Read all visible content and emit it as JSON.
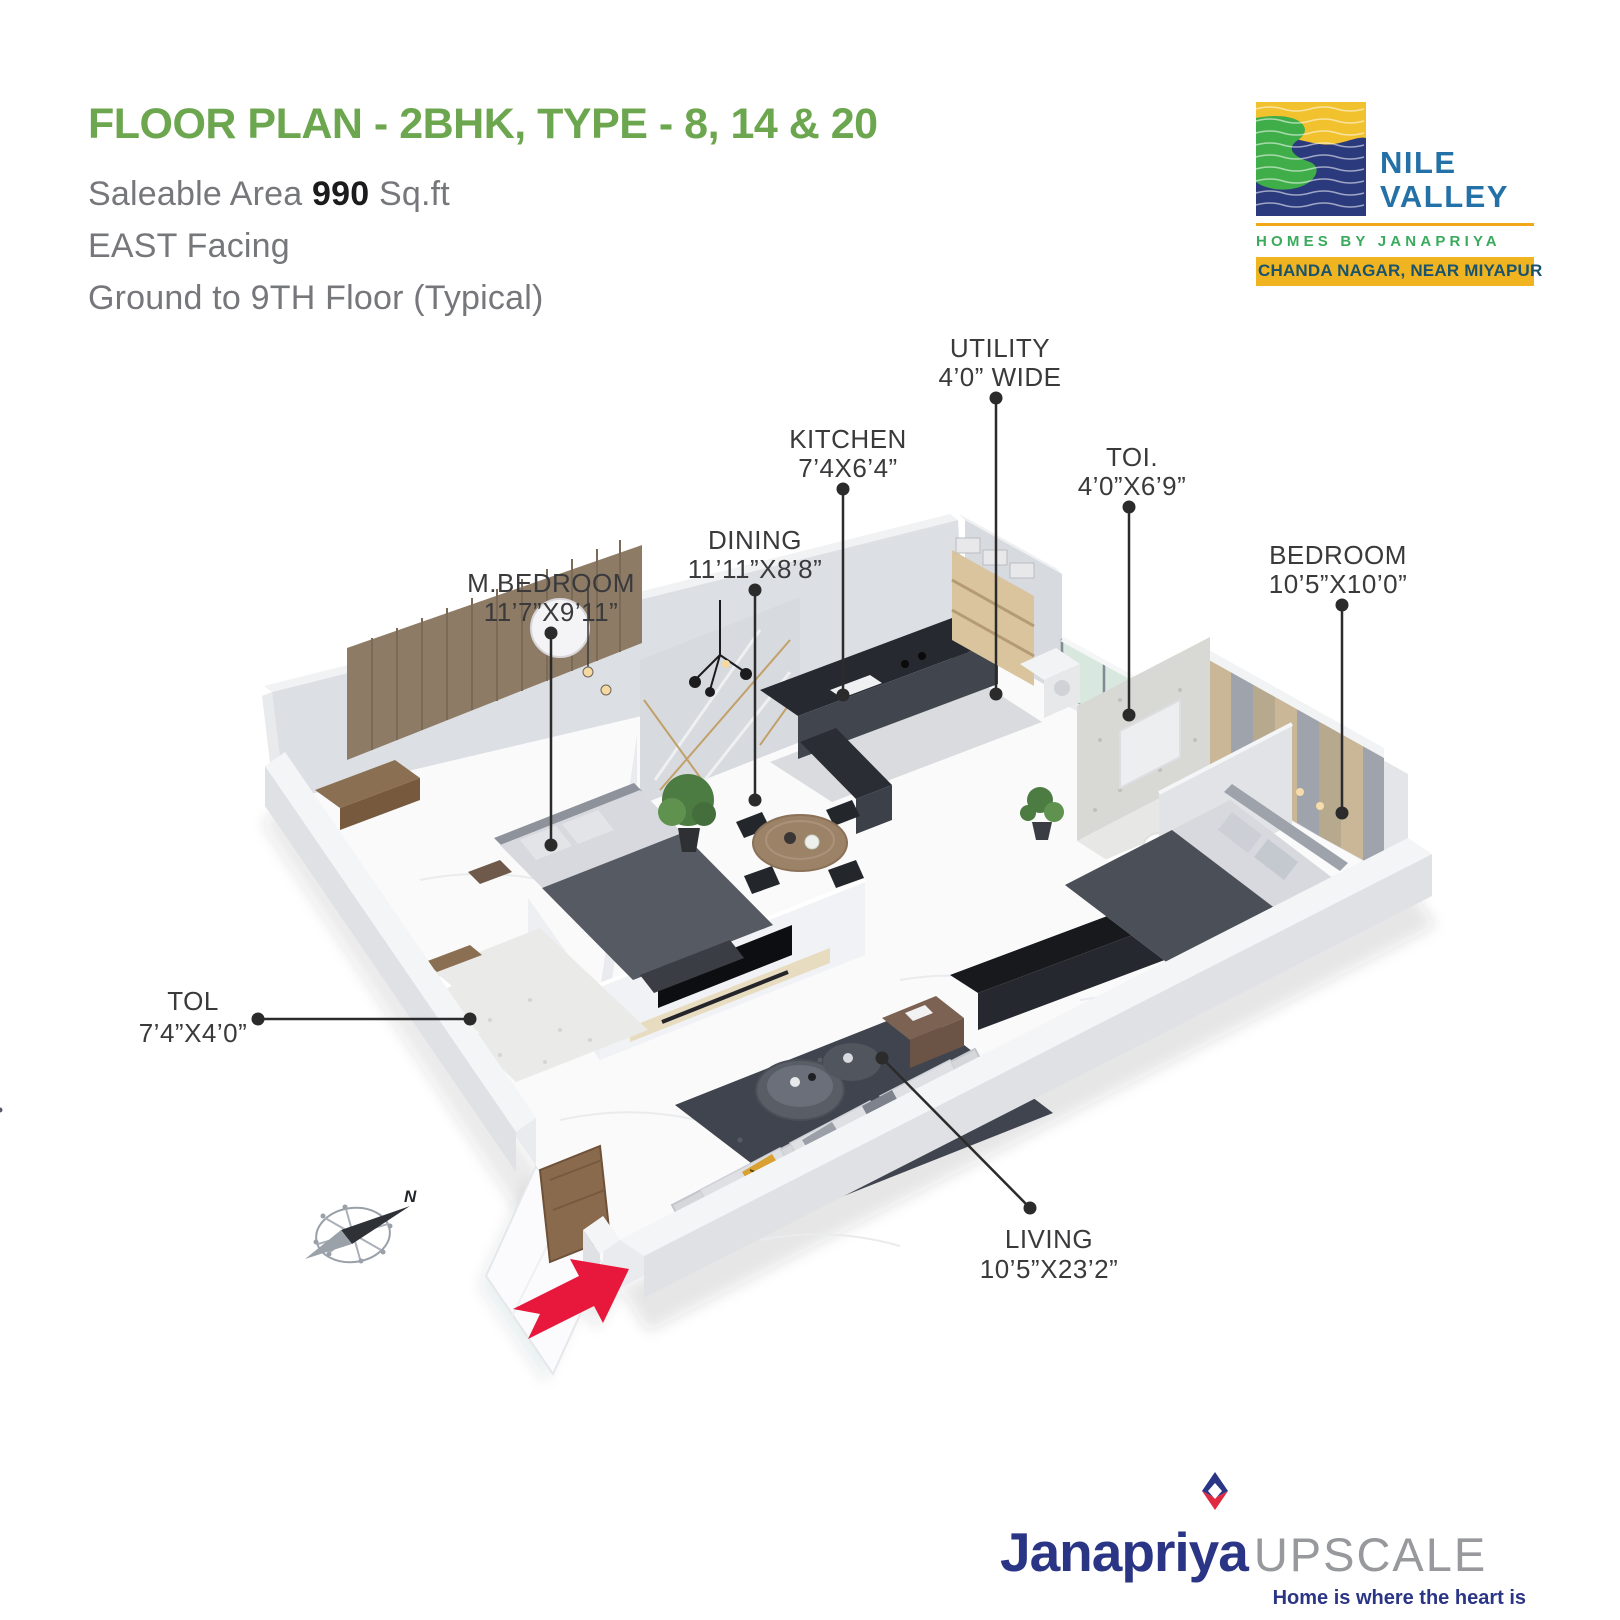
{
  "header": {
    "title": "FLOOR PLAN - 2BHK, TYPE - 8, 14 & 20",
    "area_label": "Saleable Area",
    "area_value": "990",
    "area_unit": "Sq.ft",
    "facing": "EAST Facing",
    "floors": "Ground to 9TH Floor (Typical)"
  },
  "brand": {
    "line1": "NILE",
    "line2": "VALLEY",
    "subtitle": "HOMES BY JANAPRIYA",
    "location": "CHANDA NAGAR, NEAR MIYAPUR",
    "colors": {
      "blue": "#2471A7",
      "green": "#3AAA5C",
      "yellow": "#EFB41F",
      "wave_navy": "#2B3A7D",
      "wave_green": "#3FAE49",
      "wave_gold": "#F2C12E"
    }
  },
  "rooms": [
    {
      "name": "UTILITY",
      "size": "4’0” WIDE"
    },
    {
      "name": "KITCHEN",
      "size": "7’4X6’4”"
    },
    {
      "name": "TOI.",
      "size": "4’0”X6’9”"
    },
    {
      "name": "DINING",
      "size": "11’11”X8’8”"
    },
    {
      "name": "M.BEDROOM",
      "size": "11’7”X9’11”"
    },
    {
      "name": "BEDROOM",
      "size": "10’5”X10’0”"
    },
    {
      "name": "TOL",
      "size": "7’4”X4’0”"
    },
    {
      "name": "LIVING",
      "size": "10’5”X23’2”"
    }
  ],
  "compass": {
    "north": "N"
  },
  "footer": {
    "brand": "Janapriya",
    "suffix": "UPSCALE",
    "tagline": "Home is where the heart is",
    "colors": {
      "navy": "#2B3585",
      "gray": "#97999C",
      "red": "#E02A3F"
    }
  },
  "accent_colors": {
    "title_green": "#6CA64E",
    "entry_arrow_red": "#E8173C"
  }
}
